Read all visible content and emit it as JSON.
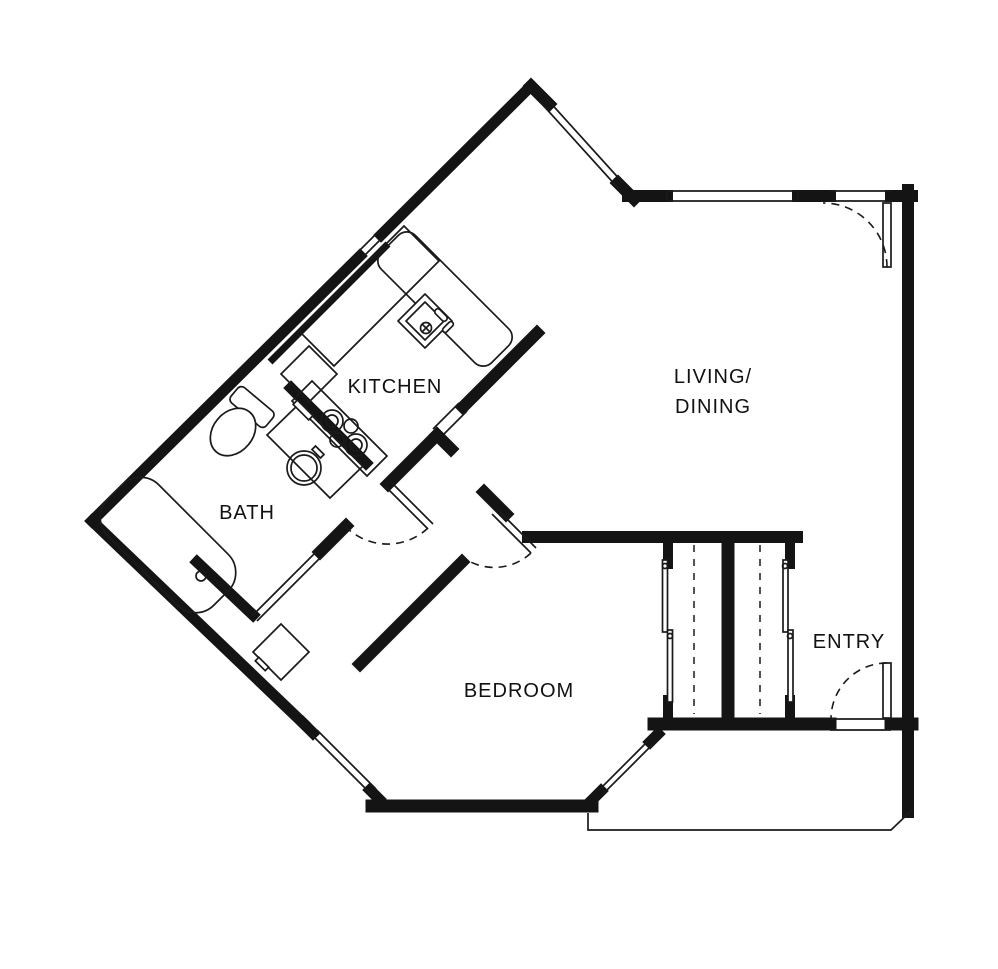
{
  "plan": {
    "type": "apartment-floor-plan",
    "background": "#ffffff",
    "colors": {
      "wall": "#141414",
      "line": "#1a1a1a",
      "label": "#111111"
    }
  },
  "rooms": {
    "kitchen": {
      "label": "KITCHEN"
    },
    "bath": {
      "label": "BATH"
    },
    "living_dining": {
      "label_line1": "LIVING/",
      "label_line2": "DINING"
    },
    "bedroom": {
      "label": "BEDROOM"
    },
    "entry": {
      "label": "ENTRY"
    }
  },
  "fixtures": [
    "bathtub",
    "toilet",
    "vanity-sink",
    "kitchen-sink",
    "cooktop-burners",
    "refrigerator",
    "kitchen-counter",
    "kitchen-peninsula-counter",
    "washer"
  ],
  "doors": [
    "entry-swing-door",
    "balcony-swing-door",
    "bedroom-swing-door",
    "bathroom-swing-door",
    "laundry-closet-door",
    "bedroom-closet-sliding-doors",
    "entry-closet-sliding-doors"
  ],
  "windows": [
    "northeast-window",
    "north-window",
    "northwest-window",
    "southwest-window",
    "southeast-window"
  ]
}
